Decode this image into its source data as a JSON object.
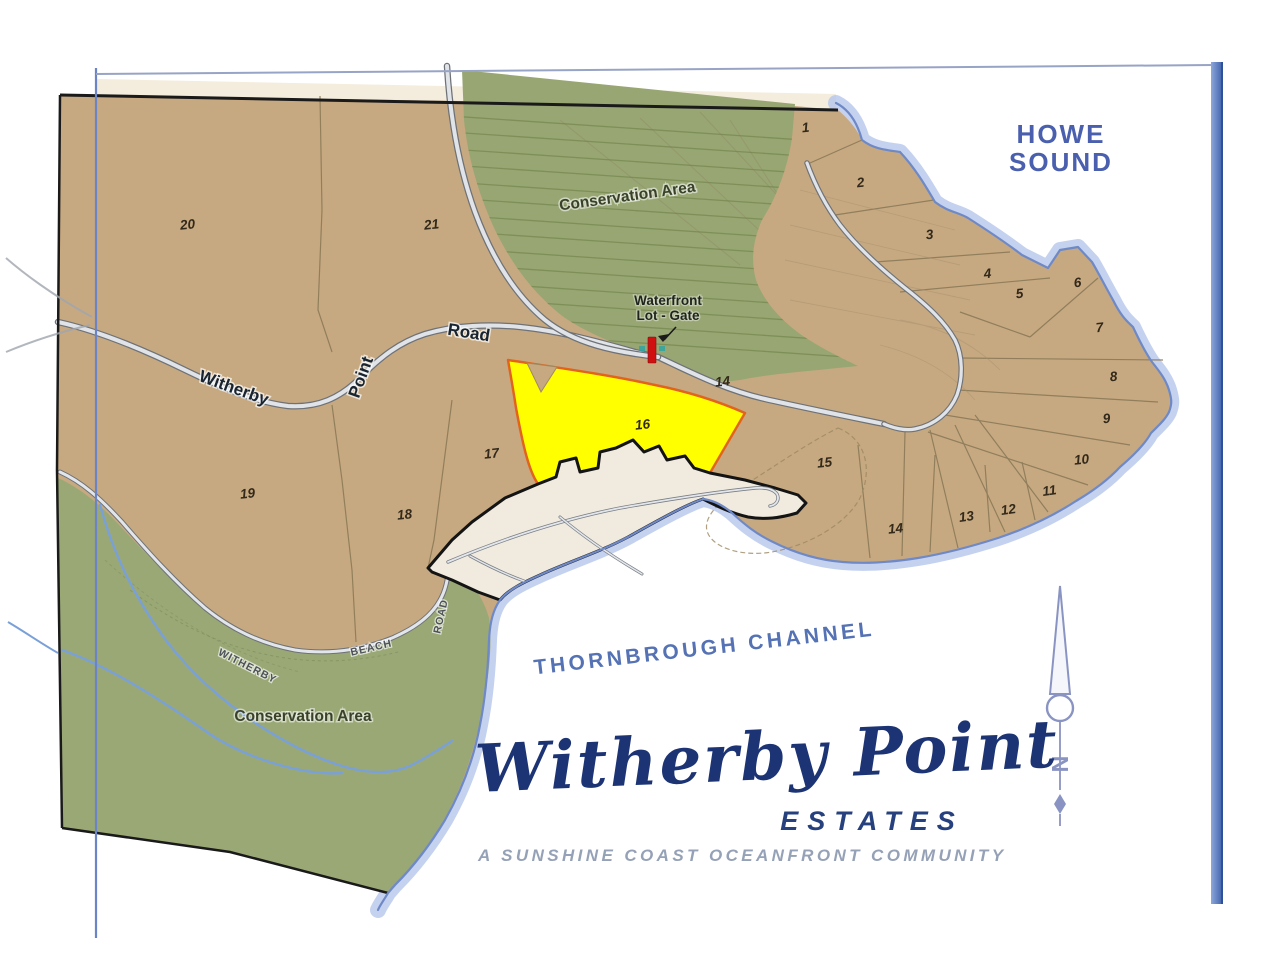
{
  "map": {
    "title_block": {
      "script_title": "Witherby Point",
      "subtitle": "ESTATES",
      "tagline": "A SUNSHINE COAST OCEANFRONT COMMUNITY"
    },
    "water_labels": {
      "howe_line1": "HOWE",
      "howe_line2": "SOUND",
      "channel": "THORNBROUGH   CHANNEL"
    },
    "area_labels": {
      "conservation_top": "Conservation Area",
      "conservation_bottom": "Conservation Area"
    },
    "gate_label": {
      "line1": "Waterfront",
      "line2": "Lot - Gate"
    },
    "road_labels": {
      "witherby": "Witherby",
      "point": "Point",
      "road": "Road",
      "beach_witherby": "WITHERBY",
      "beach_beach": "BEACH",
      "beach_road": "ROAD"
    },
    "compass": {
      "north": "N"
    },
    "highlighted_lot": "16",
    "lots": [
      {
        "label": "1",
        "x": 806,
        "y": 132,
        "rot": -6
      },
      {
        "label": "2",
        "x": 861,
        "y": 187,
        "rot": -6
      },
      {
        "label": "3",
        "x": 930,
        "y": 239,
        "rot": -6
      },
      {
        "label": "4",
        "x": 988,
        "y": 278,
        "rot": -6
      },
      {
        "label": "5",
        "x": 1020,
        "y": 298,
        "rot": -6
      },
      {
        "label": "6",
        "x": 1078,
        "y": 287,
        "rot": -6
      },
      {
        "label": "7",
        "x": 1100,
        "y": 332,
        "rot": -6
      },
      {
        "label": "8",
        "x": 1114,
        "y": 381,
        "rot": -6
      },
      {
        "label": "9",
        "x": 1107,
        "y": 423,
        "rot": -6
      },
      {
        "label": "10",
        "x": 1082,
        "y": 464,
        "rot": -6
      },
      {
        "label": "11",
        "x": 1050,
        "y": 495,
        "rot": -8
      },
      {
        "label": "12",
        "x": 1009,
        "y": 514,
        "rot": -8
      },
      {
        "label": "13",
        "x": 967,
        "y": 521,
        "rot": -8
      },
      {
        "label": "14",
        "x": 896,
        "y": 533,
        "rot": -6
      },
      {
        "label": "14",
        "x": 723,
        "y": 386,
        "rot": -6
      },
      {
        "label": "15",
        "x": 825,
        "y": 467,
        "rot": -6
      },
      {
        "label": "16",
        "x": 643,
        "y": 429,
        "rot": -6
      },
      {
        "label": "17",
        "x": 492,
        "y": 458,
        "rot": -6
      },
      {
        "label": "18",
        "x": 405,
        "y": 519,
        "rot": -6
      },
      {
        "label": "19",
        "x": 248,
        "y": 498,
        "rot": -6
      },
      {
        "label": "20",
        "x": 188,
        "y": 229,
        "rot": -6
      },
      {
        "label": "21",
        "x": 432,
        "y": 229,
        "rot": -6
      }
    ],
    "colors": {
      "land_tan": "#c7a981",
      "conservation_green": "#98a673",
      "highlight_yellow": "#ffff00",
      "highlight_outline": "#e2641c",
      "road_fill": "#e0e4e9",
      "road_casing": "#6e7277",
      "shore_glow": "#b5c7ec",
      "shore_line": "#6e89c6",
      "creek_blue": "#7aa0d8",
      "boundary_black": "#1a1a1a",
      "title_navy": "#1d3474",
      "water_label_blue": "#4a5fae",
      "frame_blue": "#3a5ea8",
      "beach_parcel": "#f1ebdf"
    }
  }
}
